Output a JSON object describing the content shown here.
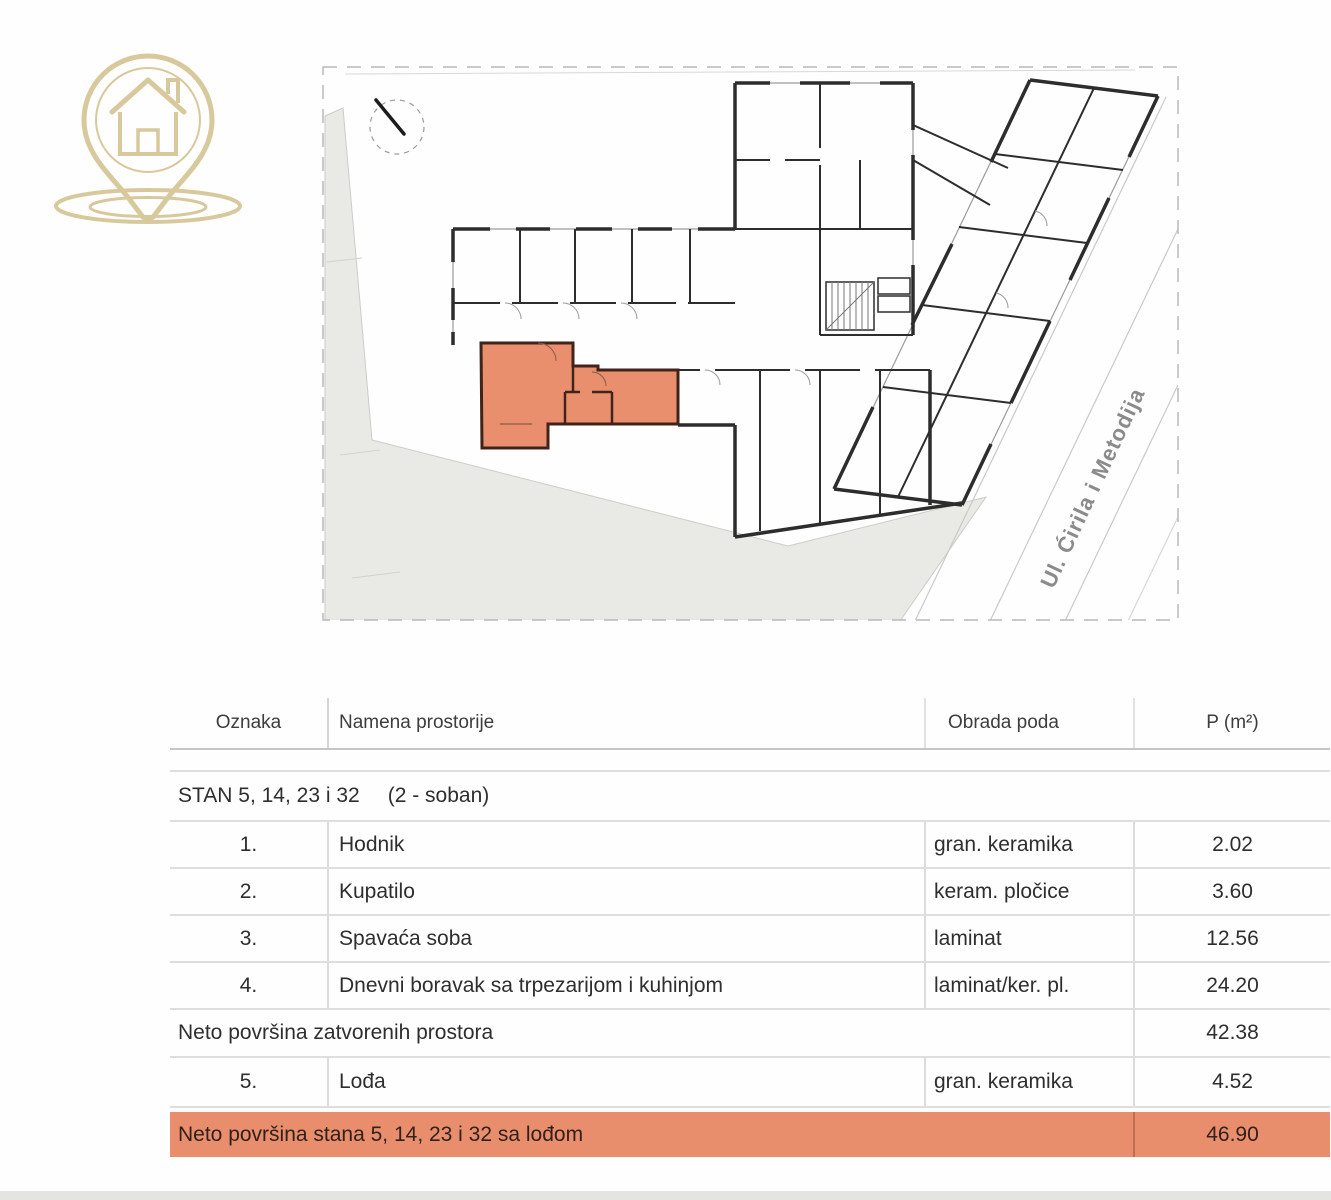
{
  "logo": {
    "icon": "house-location-pin",
    "color": "#d8c99c"
  },
  "plan": {
    "street_label": "Ul. Ćirila i Metodija",
    "highlight_color": "#e98e6d",
    "compass": "north-arrow"
  },
  "table": {
    "headers": {
      "oznaka": "Oznaka",
      "namena": "Namena prostorije",
      "obrada": "Obrada poda",
      "p": "P (m²)"
    },
    "section": {
      "title": "STAN 5, 14, 23 i 32",
      "subtitle": "(2 - soban)"
    },
    "rows": [
      {
        "num": "1.",
        "name": "Hodnik",
        "floor": "gran. keramika",
        "area": "2.02"
      },
      {
        "num": "2.",
        "name": "Kupatilo",
        "floor": "keram. pločice",
        "area": "3.60"
      },
      {
        "num": "3.",
        "name": "Spavaća soba",
        "floor": "laminat",
        "area": "12.56"
      },
      {
        "num": "4.",
        "name": "Dnevni boravak sa trpezarijom i kuhinjom",
        "floor": "laminat/ker. pl.",
        "area": "24.20"
      }
    ],
    "subtotal": {
      "label": "Neto površina zatvorenih prostora",
      "area": "42.38"
    },
    "loggia_row": {
      "num": "5.",
      "name": "Lođa",
      "floor": "gran. keramika",
      "area": "4.52"
    },
    "total": {
      "label": "Neto površina stana 5, 14, 23 i 32 sa lođom",
      "area": "46.90"
    }
  }
}
